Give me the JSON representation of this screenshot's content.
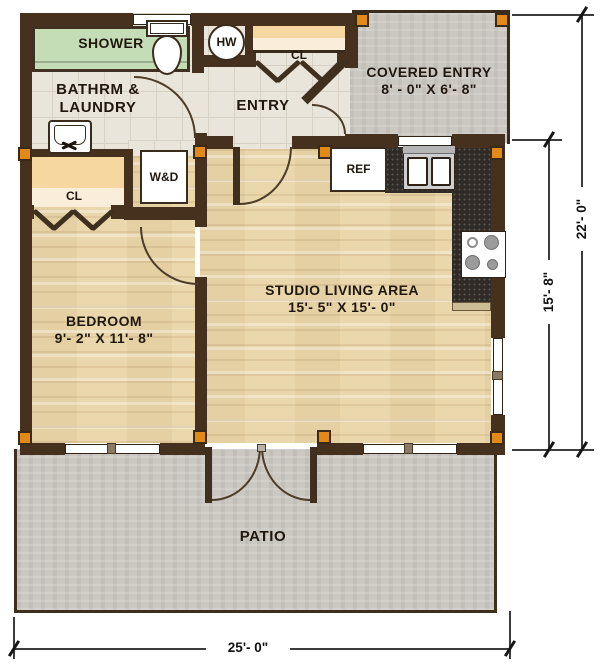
{
  "rooms": {
    "bathroom": {
      "line1": "BATHRM &",
      "line2": "LAUNDRY"
    },
    "entry": {
      "label": "ENTRY"
    },
    "covered_entry": {
      "label": "COVERED ENTRY",
      "dims": "8' - 0\" X 6'- 8\""
    },
    "studio": {
      "label": "STUDIO LIVING AREA",
      "dims": "15'- 5\" X 15'- 0\""
    },
    "bedroom": {
      "label": "BEDROOM",
      "dims": "9'- 2\" X 11'- 8\""
    },
    "patio": {
      "label": "PATIO"
    }
  },
  "fixtures": {
    "shower": "SHOWER",
    "water_heater": "HW",
    "washer_dryer": "W&D",
    "refrigerator": "REF",
    "entry_closet": "CL",
    "bedroom_closet": "CL"
  },
  "dimensions": {
    "overall_width": "25'- 0\"",
    "overall_height": "22'- 0\"",
    "living_depth": "15'- 8\""
  },
  "colors": {
    "wall": "#46311f",
    "post": "#e18a18",
    "shower_green": "#c5ddb6",
    "wood_floor": "#ead7ab",
    "tile_floor": "#e9e5da",
    "concrete": "#cbc7c1",
    "counter": "#302b26"
  }
}
